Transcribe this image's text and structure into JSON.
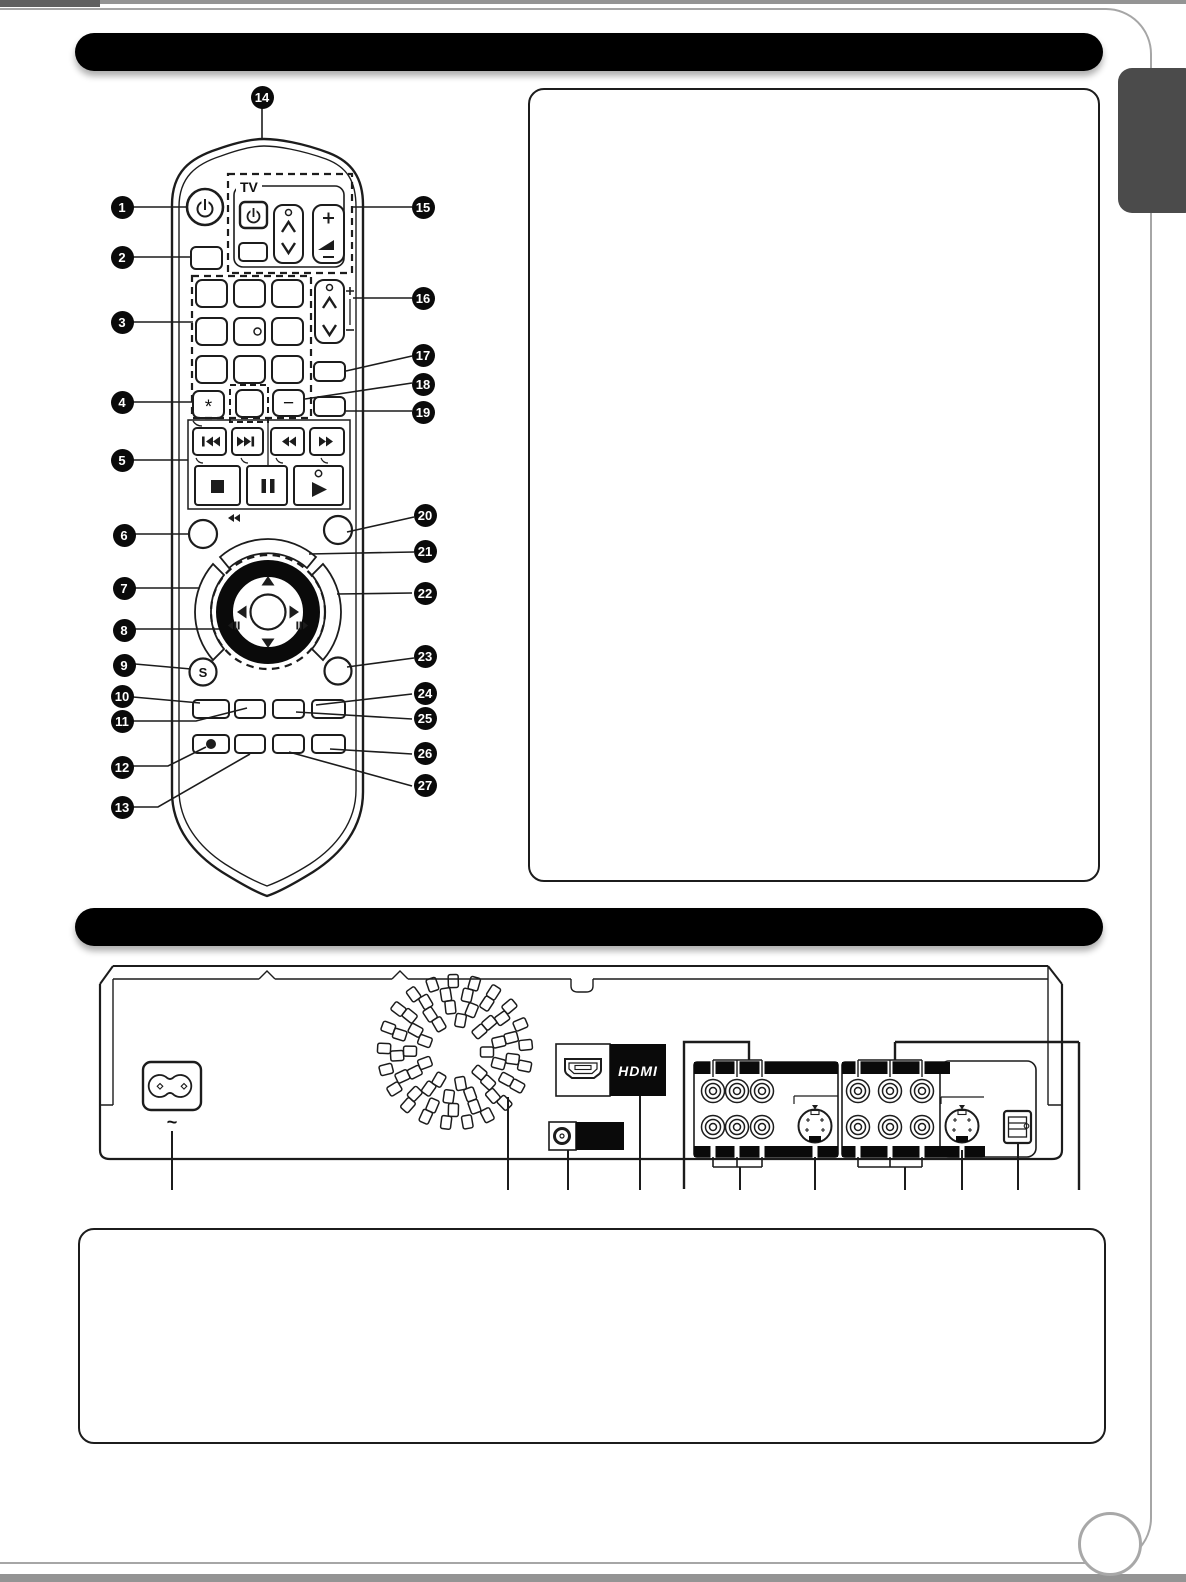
{
  "remote": {
    "callouts": [
      "1",
      "2",
      "3",
      "4",
      "5",
      "6",
      "7",
      "8",
      "9",
      "10",
      "11",
      "12",
      "13",
      "14",
      "15",
      "16",
      "17",
      "18",
      "19",
      "20",
      "21",
      "22",
      "23",
      "24",
      "25",
      "26",
      "27"
    ],
    "labels": {
      "tv": "TV",
      "s_button": "S",
      "asterisk": "*",
      "minus_button": "−"
    }
  },
  "rear_panel": {
    "hdmi_logo": "HDMI",
    "ac_symbol": "~"
  }
}
